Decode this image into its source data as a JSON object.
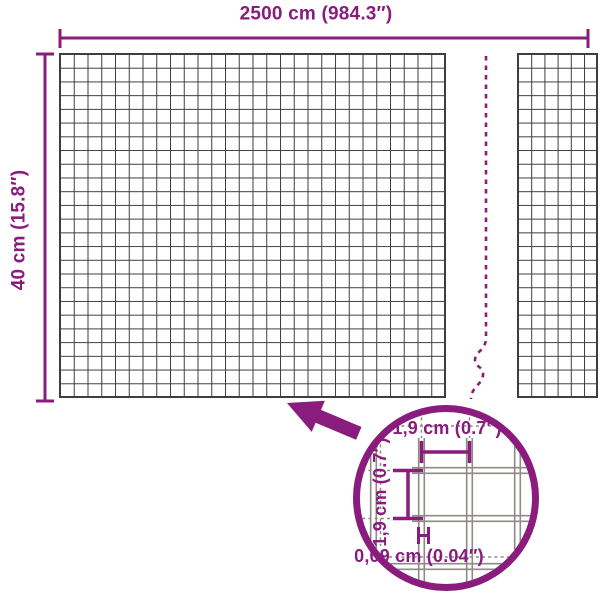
{
  "diagram_title": "wire-mesh-panel-dimension-diagram",
  "labels": {
    "total_width": "2500 cm (984.3″)",
    "total_height": "40 cm (15.8″)",
    "cell_width": "1,9 cm (0.7″)",
    "cell_height": "1,9 cm (0.7″)",
    "wire_thickness": "0,09 cm (0.04″)"
  },
  "colors": {
    "accent_purple": "#891C7C",
    "mesh_line": "#3E3E3E",
    "wire_line": "#8E8B87",
    "background": "#FFFFFF"
  },
  "icons": {
    "detail_arrow": "thick purple arrow pointing from magnifier circle to mesh",
    "break_line": "dashed purple vertical break with zigzag",
    "magnifier_circle": "purple detail circle showing mesh close-up"
  }
}
